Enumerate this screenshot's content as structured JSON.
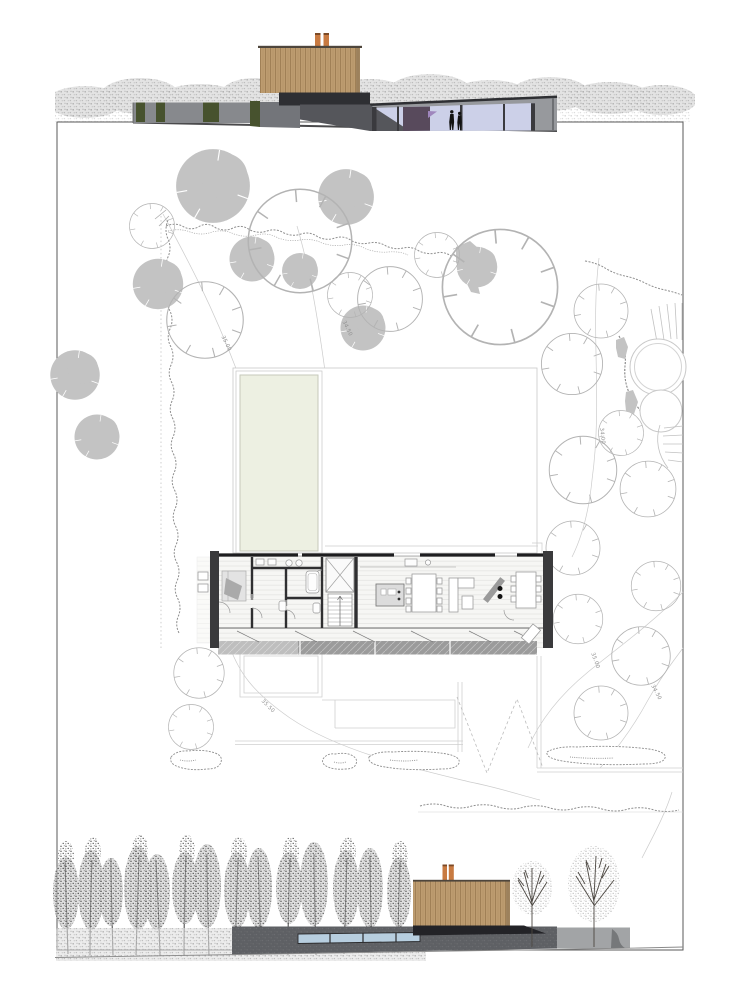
{
  "palette": {
    "wood": "#bd9c70",
    "wood_line": "#99794f",
    "wood_cap": "#4e463c",
    "chimney": "#c87a41",
    "chimney_cap": "#7c4a26",
    "green_strip": "#47522e",
    "brick_light": "#87898d",
    "brick_mid": "#73757a",
    "brick_dark": "#55565b",
    "brick_pale": "#97999d",
    "roof_dark": "#2e2f33",
    "glass_upper": "#ccd0e8",
    "glass_lower": "#b7cedf",
    "purple_panel": "#584a5c",
    "purple_accent": "#9f86bd",
    "tree_fill": "#c3c3c3",
    "tree_line": "#b3b3b3",
    "hedge": "#8f8f8f",
    "contour": "#cccccc",
    "label": "#8e8e8e",
    "frame": "#5a5a5a",
    "pool_fill": "#edf0e2",
    "pool_line": "#c6c9bb",
    "plan_wall": "#2f2f31",
    "plan_poche": "#8e8e8e",
    "floor": "#f6f6f4",
    "terrace": "#9b9b9b",
    "elev_wall_dark": "#5e6064",
    "elev_wall_light": "#a2a4a6",
    "ground": "#8a8a8a",
    "tree_dark": "#3c3c3c"
  },
  "site_plan": {
    "contour_labels": [
      {
        "text": "35.00"
      },
      {
        "text": "34.50"
      },
      {
        "text": "34.00"
      },
      {
        "text": "35.50"
      },
      {
        "text": "35.00"
      },
      {
        "text": "34.50"
      }
    ]
  }
}
